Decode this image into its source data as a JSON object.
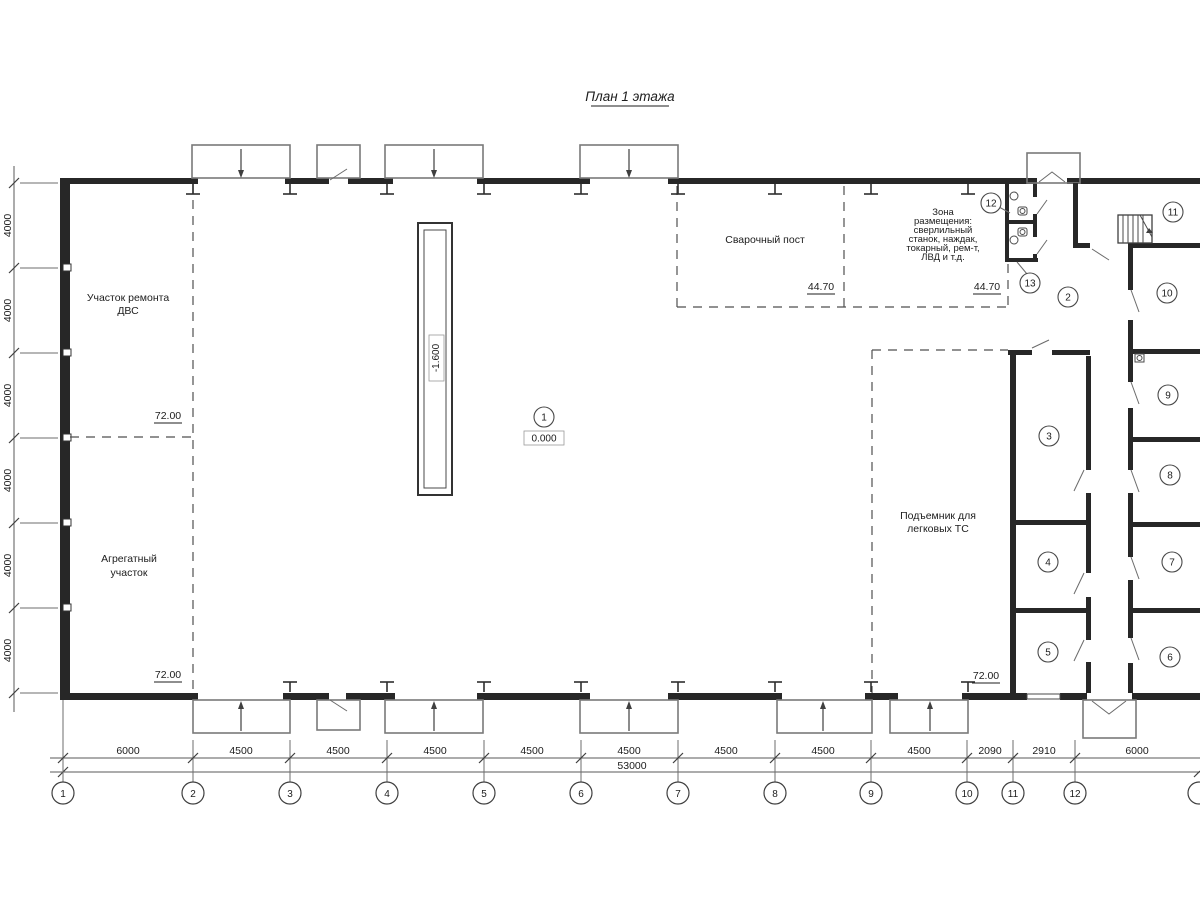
{
  "title": "План 1 этажа",
  "labels": {
    "engine_repair_lines": [
      "Участок ремонта",
      "ДВС"
    ],
    "aggregate_lines": [
      "Агрегатный",
      "участок"
    ],
    "welding_post": "Сварочный пост",
    "equipment_zone_lines": [
      "Зона",
      "размещения:",
      "сверлильный",
      "станок, наждак,",
      "токарный, рем-т,",
      "ЛВД и т.д."
    ],
    "car_lift_lines": [
      "Подъемник для",
      "легковых ТС"
    ]
  },
  "marks": {
    "area_left": "72.00",
    "area_welding": "44.70",
    "pit_depth": "-1.600",
    "hall_marker": "1",
    "hall_level": "0.000"
  },
  "room_markers": [
    "2",
    "3",
    "4",
    "5",
    "6",
    "7",
    "8",
    "9",
    "10",
    "11",
    "12",
    "13"
  ],
  "grid": {
    "axis_labels": [
      "1",
      "2",
      "3",
      "4",
      "5",
      "6",
      "7",
      "8",
      "9",
      "10",
      "11",
      "12"
    ],
    "bottom_dims": [
      "6000",
      "4500",
      "4500",
      "4500",
      "4500",
      "4500",
      "4500",
      "4500",
      "4500",
      "2090",
      "2910",
      "6000"
    ],
    "total_dim": "53000",
    "left_dims": [
      "4000",
      "4000",
      "4000",
      "4000",
      "4000",
      "4000"
    ]
  }
}
